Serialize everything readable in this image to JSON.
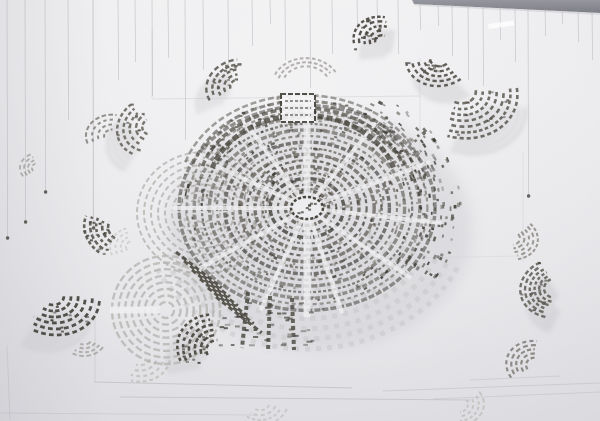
{
  "scene": {
    "seed": 20240711,
    "width": 600,
    "height": 421,
    "colors": {
      "bgTop": "#f6f6f7",
      "bgMid": "#efeff1",
      "bgEdge": "#e5e5e8",
      "bandTop": "#96969e",
      "bandBottom": "#7d7d86",
      "string": "#a0a0a8",
      "clip": "#4c4a44",
      "sheet": "#8c8c92",
      "inkDark": "#3e3b35",
      "inkMid": "#5a564e",
      "inkLight": "#8d897f",
      "ghost": "#c8c8cc",
      "faint": "#c2c2c4",
      "aisle": "#efeff1",
      "noise": [
        "#3e3b35",
        "#56534b",
        "#6b675e",
        "#8a867c"
      ]
    },
    "band": {
      "points": "412,0 600,0 600,13 414,4"
    },
    "highlight": {
      "x": 488,
      "y": 24,
      "w": 26,
      "h": 5,
      "rot": -8
    },
    "strings": [
      [
        7,
        0,
        238,
        1
      ],
      [
        25,
        0,
        222,
        1
      ],
      [
        45,
        0,
        192,
        1
      ],
      [
        68,
        0,
        120,
        0
      ],
      [
        93,
        0,
        228,
        1
      ],
      [
        118,
        0,
        80,
        0
      ],
      [
        135,
        0,
        62,
        0
      ],
      [
        152,
        0,
        96,
        0
      ],
      [
        168,
        0,
        58,
        0
      ],
      [
        185,
        0,
        140,
        0
      ],
      [
        203,
        0,
        70,
        0
      ],
      [
        228,
        0,
        68,
        0
      ],
      [
        252,
        0,
        46,
        0
      ],
      [
        270,
        0,
        24,
        0
      ],
      [
        285,
        0,
        60,
        0
      ],
      [
        310,
        0,
        88,
        0
      ],
      [
        332,
        0,
        54,
        0
      ],
      [
        357,
        0,
        30,
        0
      ],
      [
        377,
        0,
        26,
        0
      ],
      [
        398,
        0,
        54,
        0
      ],
      [
        420,
        2,
        30,
        0
      ],
      [
        438,
        3,
        26,
        0
      ],
      [
        452,
        4,
        56,
        0
      ],
      [
        468,
        4,
        80,
        0
      ],
      [
        483,
        5,
        86,
        0
      ],
      [
        500,
        5,
        40,
        0
      ],
      [
        515,
        6,
        62,
        0
      ],
      [
        528,
        6,
        196,
        1
      ],
      [
        545,
        7,
        36,
        0
      ],
      [
        562,
        8,
        24,
        0
      ],
      [
        578,
        9,
        42,
        0
      ],
      [
        592,
        10,
        60,
        0
      ]
    ],
    "sheets": [
      [
        152,
        30,
        152,
        98,
        0.18
      ],
      [
        152,
        99,
        420,
        96,
        0.18
      ],
      [
        420,
        58,
        420,
        162,
        0.15
      ],
      [
        93,
        0,
        93,
        242,
        0.12
      ],
      [
        95,
        382,
        352,
        388,
        0.3
      ],
      [
        95,
        300,
        95,
        383,
        0.18
      ],
      [
        120,
        397,
        470,
        400,
        0.28
      ],
      [
        383,
        391,
        600,
        383,
        0.22
      ],
      [
        433,
        399,
        600,
        392,
        0.2
      ],
      [
        470,
        380,
        560,
        376,
        0.2
      ],
      [
        523,
        152,
        523,
        262,
        0.12
      ],
      [
        7,
        345,
        10,
        420,
        0.18
      ],
      [
        0,
        413,
        255,
        415,
        0.18
      ],
      [
        298,
        260,
        520,
        256,
        0.1
      ]
    ],
    "central": {
      "cx": 307,
      "cy": 208,
      "ringInner": 14,
      "ringOuter": 128,
      "ringCount": 16,
      "squash": 0.8,
      "aisles": [
        -90,
        -57,
        -25,
        8,
        40,
        75,
        110,
        145,
        180,
        -150,
        -120,
        90
      ],
      "noiseCount": 520,
      "wedgeCount": 160,
      "galleryNoise": 80,
      "gallery": {
        "cx": 303,
        "cy": 190,
        "rx": [
          95,
          105,
          115,
          123
        ],
        "ry": [
          75,
          82,
          89,
          95
        ],
        "a0": 197,
        "a1": 343
      },
      "box": {
        "x": 281,
        "y": 94,
        "w": 34,
        "h": 28
      },
      "subLeft": {
        "cx": 203,
        "cy": 213,
        "r0": 10,
        "r1": 66,
        "n": 9
      },
      "subBL": {
        "cx": 166,
        "cy": 310,
        "r0": 8,
        "r1": 54,
        "n": 8
      },
      "fanBottom": {
        "r0": 70,
        "r1": 166,
        "n": 9,
        "a0": 25,
        "a1": 155
      },
      "diagRows": {
        "starts": [
          [
            176,
            252
          ],
          [
            184,
            261
          ],
          [
            192,
            270
          ],
          [
            200,
            279
          ],
          [
            208,
            288
          ],
          [
            216,
            297
          ]
        ],
        "angle": 38,
        "len": 58
      },
      "columns": [
        [
          248,
          292,
          242,
          348
        ],
        [
          270,
          296,
          268,
          352
        ],
        [
          292,
          298,
          294,
          350
        ]
      ],
      "clusterBox": {
        "x": 218,
        "y": 300,
        "w": 95,
        "h": 46,
        "n": 40
      }
    },
    "fragments": [
      [
        238,
        86,
        8,
        32,
        5,
        170,
        285,
        -15,
        "#57544c",
        2.4,
        0.85,
        1
      ],
      [
        306,
        86,
        24,
        34,
        3,
        200,
        330,
        0,
        "#8a867e",
        2,
        0.6,
        0
      ],
      [
        383,
        42,
        8,
        30,
        5,
        150,
        262,
        20,
        "#47443d",
        2.4,
        0.9,
        1
      ],
      [
        440,
        58,
        10,
        34,
        5,
        60,
        185,
        -10,
        "#4a473f",
        2.4,
        0.85,
        1
      ],
      [
        460,
        90,
        16,
        58,
        7,
        -15,
        95,
        15,
        "#514e46",
        2.6,
        0.8,
        1
      ],
      [
        152,
        126,
        10,
        36,
        5,
        140,
        255,
        -25,
        "#5a564e",
        2.4,
        0.8,
        1
      ],
      [
        112,
        136,
        8,
        26,
        4,
        160,
        275,
        0,
        "#6b675f",
        2,
        0.7,
        0
      ],
      [
        124,
        228,
        16,
        40,
        5,
        115,
        195,
        10,
        "#4e4b43",
        2.6,
        0.85,
        0
      ],
      [
        52,
        295,
        12,
        48,
        6,
        -10,
        105,
        15,
        "#43403a",
        2.8,
        0.9,
        1
      ],
      [
        84,
        338,
        8,
        22,
        4,
        30,
        120,
        0,
        "#8f8b83",
        2,
        0.6,
        0
      ],
      [
        140,
        357,
        10,
        30,
        4,
        10,
        110,
        0,
        "#b4b2ae",
        2.2,
        0.6,
        0
      ],
      [
        220,
        352,
        14,
        44,
        6,
        140,
        235,
        25,
        "#45423b",
        2.6,
        0.9,
        1
      ],
      [
        556,
        288,
        12,
        36,
        6,
        120,
        250,
        -10,
        "#55524a",
        2.4,
        0.8,
        1
      ],
      [
        536,
        366,
        10,
        30,
        5,
        140,
        260,
        15,
        "#6b675f",
        2.2,
        0.7,
        0
      ],
      [
        458,
        404,
        10,
        26,
        4,
        -30,
        80,
        0,
        "#b2b0ac",
        2,
        0.55,
        0
      ],
      [
        512,
        238,
        8,
        26,
        5,
        -50,
        70,
        10,
        "#7a766e",
        2,
        0.7,
        0
      ],
      [
        260,
        402,
        10,
        28,
        4,
        20,
        130,
        0,
        "#b4b2ae",
        2,
        0.5,
        0
      ],
      [
        38,
        168,
        6,
        18,
        4,
        140,
        250,
        0,
        "#8b877f",
        1.8,
        0.6,
        0
      ],
      [
        134,
        247,
        8,
        24,
        4,
        150,
        250,
        0,
        "#b7b5b1",
        1.8,
        0.5,
        0
      ]
    ]
  }
}
